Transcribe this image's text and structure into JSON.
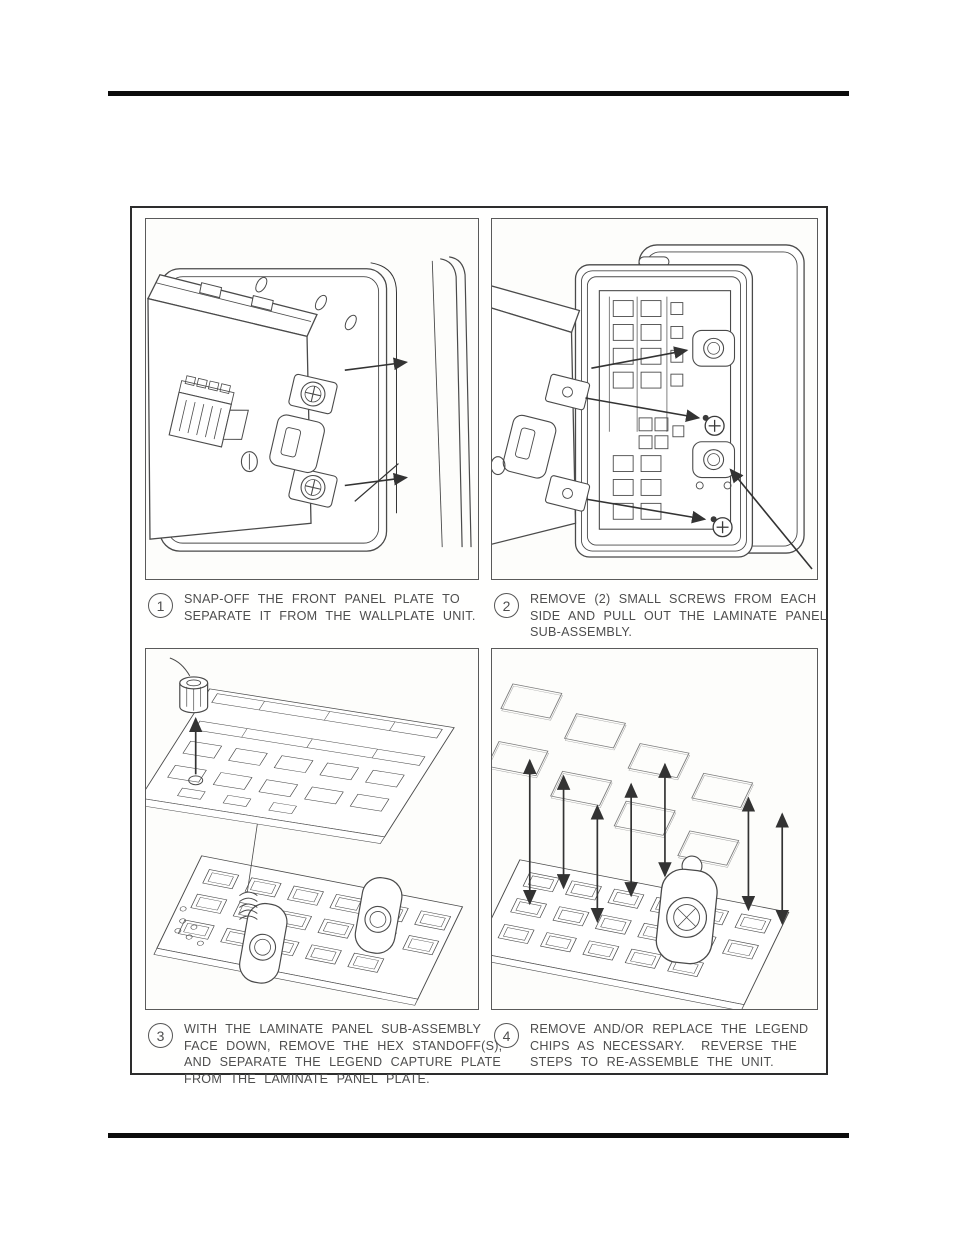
{
  "document": {
    "kind": "scanned manual page",
    "background_color": "#ffffff",
    "rule_color": "#0c0c0c"
  },
  "figure": {
    "border_color": "#2d2d2d",
    "panel_border_color": "#5a5a5a",
    "line_art_color": "#4a4a4a",
    "arrow_color": "#333333",
    "steps": [
      {
        "number": "1",
        "illustration": "wallplate-unit-front-panel-snap-off",
        "caption_lines": [
          "SNAP-OFF THE FRONT PANEL PLATE TO",
          "SEPARATE IT FROM THE WALLPLATE UNIT."
        ]
      },
      {
        "number": "2",
        "illustration": "remove-screws-pull-out-laminate-panel-sub-assembly",
        "caption_lines": [
          "REMOVE (2) SMALL SCREWS FROM EACH",
          "SIDE AND PULL OUT THE LAMINATE PANEL",
          "SUB-ASSEMBLY."
        ]
      },
      {
        "number": "3",
        "illustration": "separate-legend-capture-plate-from-laminate-panel-plate",
        "caption_lines": [
          "WITH THE LAMINATE PANEL SUB-ASSEMBLY",
          "FACE DOWN, REMOVE THE HEX STANDOFF(S),",
          "AND SEPARATE THE LEGEND CAPTURE PLATE",
          "FROM THE LAMINATE PANEL PLATE."
        ]
      },
      {
        "number": "4",
        "illustration": "remove-or-replace-legend-chips",
        "caption_lines": [
          "REMOVE AND/OR REPLACE THE LEGEND",
          "CHIPS AS NECESSARY.  REVERSE THE",
          "STEPS TO RE-ASSEMBLE THE UNIT."
        ]
      }
    ]
  }
}
